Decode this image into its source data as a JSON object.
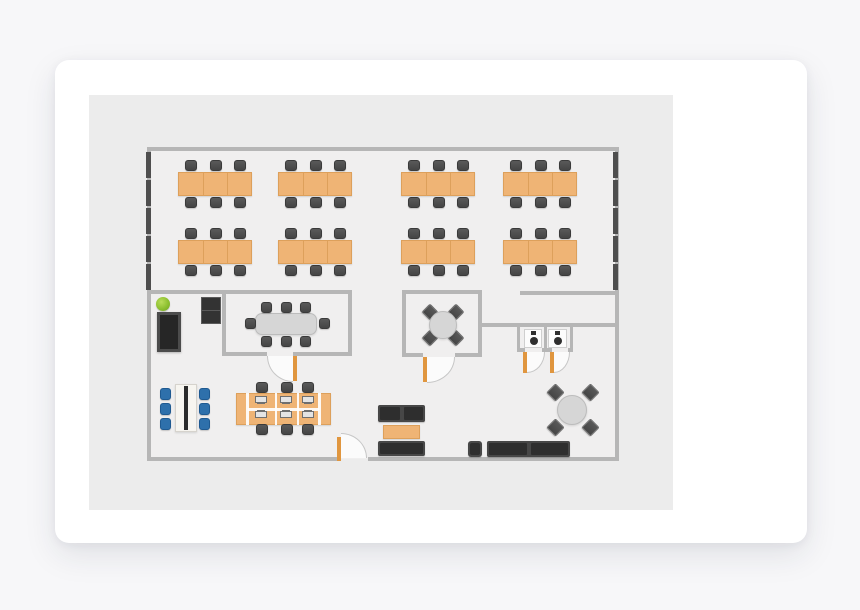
{
  "palette": {
    "pagebg": "#f7f7f9",
    "cardbg": "#ffffff",
    "canvasbg": "#ececec",
    "floor": "#f0efef",
    "wall": "#b6b6b6",
    "window": "#4e4e4e",
    "desk": "#efb475",
    "deskb": "#dda05b",
    "table": "#d6d6d6",
    "tableb": "#bcbcbc",
    "door": "#e0963f",
    "arc": "#c6c6c6",
    "blue": "#2e70ab",
    "sofa": "#474747",
    "cushion": "#2e2e2e",
    "toilet": "#2f2f2f",
    "whitetable": "#f7f5f0"
  },
  "floorplan": {
    "canvas": {
      "x": 34,
      "y": 35,
      "w": 584,
      "h": 415
    },
    "items": [
      {
        "t": "floor",
        "b": [
          58,
          52,
          472,
          312
        ]
      },
      {
        "t": "wall",
        "b": [
          58,
          52,
          472,
          4
        ]
      },
      {
        "t": "wall",
        "b": [
          58,
          52,
          4,
          314
        ]
      },
      {
        "t": "wall",
        "b": [
          526,
          52,
          4,
          314
        ]
      },
      {
        "t": "wall",
        "b": [
          58,
          362,
          194,
          4
        ]
      },
      {
        "t": "wall",
        "b": [
          279,
          362,
          251,
          4
        ]
      },
      {
        "t": "wall",
        "b": [
          58,
          195,
          79,
          4
        ]
      },
      {
        "t": "wall",
        "b": [
          431,
          196,
          99,
          4
        ]
      },
      {
        "t": "wall",
        "b": [
          133,
          195,
          130,
          4
        ]
      },
      {
        "t": "wall",
        "b": [
          133,
          195,
          4,
          66
        ]
      },
      {
        "t": "wall",
        "b": [
          259,
          195,
          4,
          66
        ]
      },
      {
        "t": "wall",
        "b": [
          133,
          257,
          45,
          4
        ]
      },
      {
        "t": "wall",
        "b": [
          204,
          257,
          59,
          4
        ]
      },
      {
        "t": "wall",
        "b": [
          313,
          195,
          80,
          4
        ]
      },
      {
        "t": "wall",
        "b": [
          313,
          195,
          4,
          67
        ]
      },
      {
        "t": "wall",
        "b": [
          389,
          195,
          4,
          67
        ]
      },
      {
        "t": "wall",
        "b": [
          313,
          258,
          21,
          4
        ]
      },
      {
        "t": "wall",
        "b": [
          366,
          258,
          27,
          4
        ]
      },
      {
        "t": "wall",
        "b": [
          393,
          228,
          137,
          4
        ]
      },
      {
        "t": "wall",
        "b": [
          428,
          232,
          3,
          25
        ]
      },
      {
        "t": "wall",
        "b": [
          455,
          232,
          3,
          25
        ]
      },
      {
        "t": "wall",
        "b": [
          481,
          232,
          3,
          25
        ]
      },
      {
        "t": "wall",
        "b": [
          428,
          253,
          8,
          4
        ]
      },
      {
        "t": "wall",
        "b": [
          453,
          253,
          10,
          4
        ]
      },
      {
        "t": "wall",
        "b": [
          479,
          253,
          5,
          4
        ]
      },
      {
        "t": "win",
        "b": [
          57,
          57,
          5,
          26
        ]
      },
      {
        "t": "win",
        "b": [
          57,
          85,
          5,
          26
        ]
      },
      {
        "t": "win",
        "b": [
          57,
          113,
          5,
          26
        ]
      },
      {
        "t": "win",
        "b": [
          57,
          141,
          5,
          26
        ]
      },
      {
        "t": "win",
        "b": [
          57,
          169,
          5,
          26
        ]
      },
      {
        "t": "win",
        "b": [
          524,
          57,
          5,
          26
        ]
      },
      {
        "t": "win",
        "b": [
          524,
          85,
          5,
          26
        ]
      },
      {
        "t": "win",
        "b": [
          524,
          113,
          5,
          26
        ]
      },
      {
        "t": "win",
        "b": [
          524,
          141,
          5,
          26
        ]
      },
      {
        "t": "win",
        "b": [
          524,
          169,
          5,
          26
        ]
      },
      {
        "t": "swing",
        "b": [
          178,
          261,
          26,
          26
        ],
        "c": "bl"
      },
      {
        "t": "swing",
        "b": [
          338,
          262,
          28,
          26
        ],
        "c": "br"
      },
      {
        "t": "swing",
        "b": [
          438,
          257,
          18,
          21
        ],
        "c": "br"
      },
      {
        "t": "swing",
        "b": [
          465,
          257,
          16,
          21
        ],
        "c": "br"
      },
      {
        "t": "swing",
        "b": [
          252,
          338,
          26,
          25
        ],
        "c": "tr"
      },
      {
        "t": "post",
        "b": [
          204,
          261,
          4,
          25
        ]
      },
      {
        "t": "post",
        "b": [
          334,
          262,
          4,
          25
        ]
      },
      {
        "t": "post",
        "b": [
          434,
          257,
          4,
          21
        ]
      },
      {
        "t": "post",
        "b": [
          461,
          257,
          4,
          21
        ]
      },
      {
        "t": "post",
        "b": [
          248,
          342,
          4,
          24
        ]
      },
      {
        "t": "cluster",
        "b": [
          89,
          77
        ]
      },
      {
        "t": "cluster",
        "b": [
          189,
          77
        ]
      },
      {
        "t": "cluster",
        "b": [
          312,
          77
        ]
      },
      {
        "t": "cluster",
        "b": [
          414,
          77
        ]
      },
      {
        "t": "cluster",
        "b": [
          89,
          145
        ]
      },
      {
        "t": "cluster",
        "b": [
          189,
          145
        ]
      },
      {
        "t": "cluster",
        "b": [
          312,
          145
        ]
      },
      {
        "t": "cluster",
        "b": [
          414,
          145
        ]
      },
      {
        "t": "confTable",
        "b": [
          166,
          218,
          62,
          22
        ]
      },
      {
        "t": "chair",
        "b": [
          172,
          207,
          11,
          11
        ]
      },
      {
        "t": "chair",
        "b": [
          192,
          207,
          11,
          11
        ]
      },
      {
        "t": "chair",
        "b": [
          211,
          207,
          11,
          11
        ]
      },
      {
        "t": "chair",
        "b": [
          172,
          241,
          11,
          11
        ]
      },
      {
        "t": "chair",
        "b": [
          192,
          241,
          11,
          11
        ]
      },
      {
        "t": "chair",
        "b": [
          211,
          241,
          11,
          11
        ]
      },
      {
        "t": "chair",
        "b": [
          156,
          223,
          11,
          11
        ]
      },
      {
        "t": "chair",
        "b": [
          230,
          223,
          11,
          11
        ]
      },
      {
        "t": "chairD",
        "b": [
          335,
          211,
          12,
          12
        ]
      },
      {
        "t": "chairD",
        "b": [
          361,
          211,
          12,
          12
        ]
      },
      {
        "t": "chairD",
        "b": [
          335,
          237,
          12,
          12
        ]
      },
      {
        "t": "chairD",
        "b": [
          361,
          237,
          12,
          12
        ]
      },
      {
        "t": "roundTable",
        "b": [
          340,
          216,
          28,
          28
        ]
      },
      {
        "t": "chairD",
        "b": [
          460,
          291,
          13,
          13
        ]
      },
      {
        "t": "chairD",
        "b": [
          495,
          291,
          13,
          13
        ]
      },
      {
        "t": "chairD",
        "b": [
          460,
          326,
          13,
          13
        ]
      },
      {
        "t": "chairD",
        "b": [
          495,
          326,
          13,
          13
        ]
      },
      {
        "t": "roundTable",
        "b": [
          468,
          300,
          30,
          30
        ]
      },
      {
        "t": "stall",
        "b": [
          435,
          234,
          18,
          19
        ]
      },
      {
        "t": "stall",
        "b": [
          459,
          234,
          19,
          19
        ]
      },
      {
        "t": "toilet",
        "b": [
          440,
          236,
          9,
          15
        ]
      },
      {
        "t": "toilet",
        "b": [
          464,
          236,
          9,
          15
        ]
      },
      {
        "t": "plant",
        "b": [
          67,
          202,
          14,
          14
        ]
      },
      {
        "t": "bookcase",
        "b": [
          68,
          217,
          24,
          40
        ]
      },
      {
        "t": "cabinet",
        "b": [
          112,
          202,
          22,
          28
        ]
      },
      {
        "t": "wtable",
        "b": [
          86,
          289,
          22,
          48
        ]
      },
      {
        "t": "chairB",
        "b": [
          71,
          293,
          11,
          12
        ]
      },
      {
        "t": "chairB",
        "b": [
          71,
          308,
          11,
          12
        ]
      },
      {
        "t": "chairB",
        "b": [
          71,
          323,
          11,
          12
        ]
      },
      {
        "t": "chairB",
        "b": [
          110,
          293,
          11,
          12
        ]
      },
      {
        "t": "chairB",
        "b": [
          110,
          308,
          11,
          12
        ]
      },
      {
        "t": "chairB",
        "b": [
          110,
          323,
          11,
          12
        ]
      },
      {
        "t": "chair",
        "b": [
          167,
          287,
          12,
          11
        ]
      },
      {
        "t": "chair",
        "b": [
          192,
          287,
          12,
          11
        ]
      },
      {
        "t": "chair",
        "b": [
          213,
          287,
          12,
          11
        ]
      },
      {
        "t": "workbank",
        "b": [
          147,
          298,
          95,
          32
        ]
      },
      {
        "t": "wline",
        "b": [
          157,
          298,
          3,
          32
        ]
      },
      {
        "t": "wline",
        "b": [
          186,
          298,
          2,
          32
        ]
      },
      {
        "t": "wline",
        "b": [
          208,
          298,
          2,
          32
        ]
      },
      {
        "t": "wline",
        "b": [
          229,
          298,
          3,
          32
        ]
      },
      {
        "t": "wline",
        "b": [
          159,
          313,
          71,
          3
        ]
      },
      {
        "t": "mon",
        "b": [
          165,
          301,
          14,
          8
        ]
      },
      {
        "t": "mon",
        "b": [
          190,
          301,
          14,
          8
        ]
      },
      {
        "t": "mon",
        "b": [
          212,
          301,
          14,
          8
        ]
      },
      {
        "t": "monF",
        "b": [
          165,
          315,
          14,
          8
        ]
      },
      {
        "t": "monF",
        "b": [
          190,
          315,
          14,
          8
        ]
      },
      {
        "t": "monF",
        "b": [
          212,
          315,
          14,
          8
        ]
      },
      {
        "t": "chair",
        "b": [
          167,
          329,
          12,
          11
        ]
      },
      {
        "t": "chair",
        "b": [
          192,
          329,
          12,
          11
        ]
      },
      {
        "t": "chair",
        "b": [
          213,
          329,
          12,
          11
        ]
      },
      {
        "t": "sofa2",
        "b": [
          289,
          310,
          47,
          17
        ]
      },
      {
        "t": "ctable",
        "b": [
          294,
          330,
          37,
          14
        ]
      },
      {
        "t": "sofa1",
        "b": [
          289,
          346,
          47,
          15
        ]
      },
      {
        "t": "armchair",
        "b": [
          379,
          346,
          14,
          16
        ]
      },
      {
        "t": "sofa2",
        "b": [
          398,
          346,
          83,
          16
        ]
      }
    ]
  }
}
